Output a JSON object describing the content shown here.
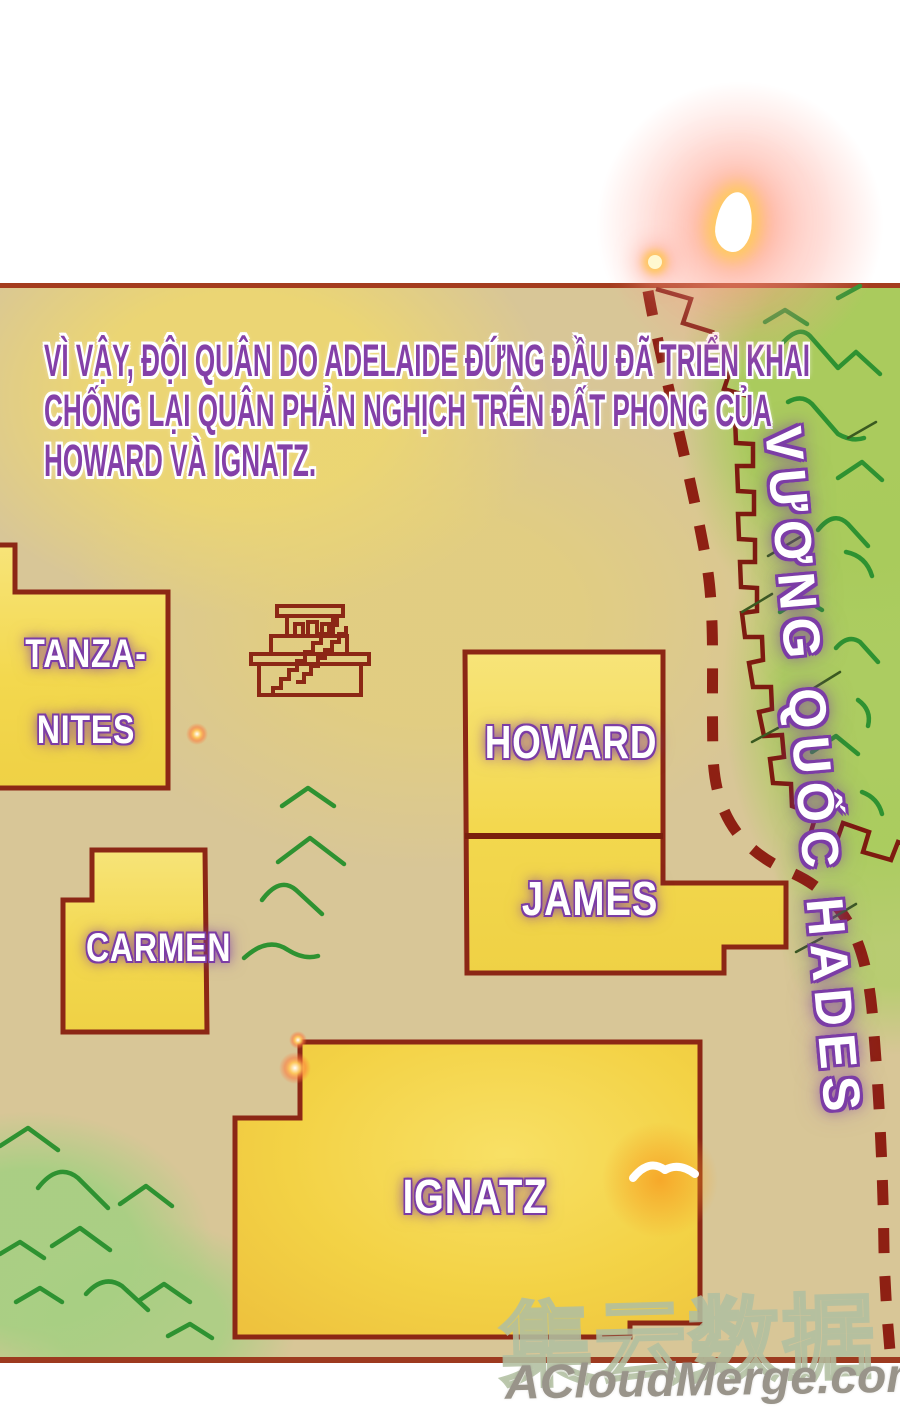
{
  "narration": {
    "lines": [
      "VÌ VẬY, ĐỘI QUÂN DO ADELAIDE ĐỨNG ĐẦU ĐÃ TRIỂN KHAI",
      "CHỐNG LẠI QUÂN PHẢN NGHỊCH TRÊN ĐẤT PHONG CỦA",
      "HOWARD VÀ IGNATZ."
    ],
    "text_color": "#8440a8"
  },
  "map": {
    "kingdom_label": "VƯƠNG QUỐC HADES",
    "regions": [
      {
        "id": "tanzanites",
        "label_lines": [
          "TANZA-",
          "NITES"
        ]
      },
      {
        "id": "carmen",
        "label": "CARMEN"
      },
      {
        "id": "howard",
        "label": "HOWARD"
      },
      {
        "id": "james",
        "label": "JAMES"
      },
      {
        "id": "ignatz",
        "label": "IGNATZ"
      }
    ],
    "icons": {
      "pyramid": "ziggurat-temple-icon",
      "bird": "bird-icon",
      "wall": "crenellated-wall-border",
      "dashes": "dashed-route-border",
      "mountains": "mountain-ridge-marks",
      "flare": "light-flare"
    },
    "colors": {
      "paper_tan": "#d8c697",
      "region_yellow": "#f3d84e",
      "region_border": "#8c2715",
      "grass_green": "#a9cb5c",
      "ridge_green": "#2e9231",
      "wall_maroon": "#8a1d12",
      "text_purple": "#8440a8"
    }
  },
  "watermark": {
    "cn": "集云数据",
    "en": "ACloudMerge.com"
  }
}
